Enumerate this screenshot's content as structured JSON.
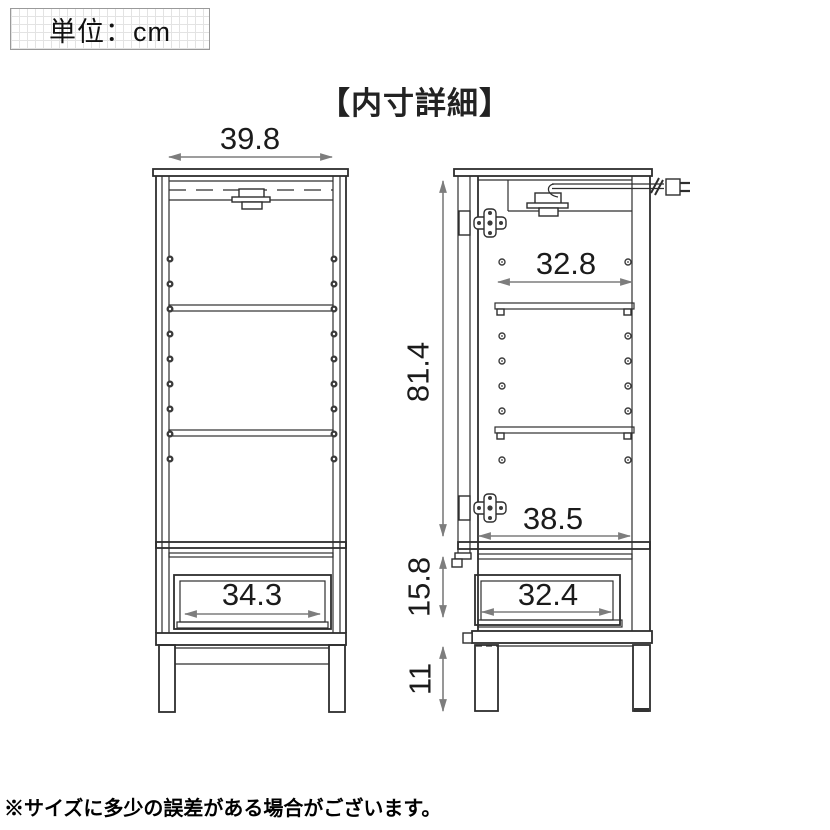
{
  "unit_box": {
    "label": "単位：cm"
  },
  "title": "【内寸詳細】",
  "note": "※サイズに多少の誤差がある場合がございます。",
  "colors": {
    "line": "#2e2e2e",
    "dimension_arrow": "#7d7d7d",
    "dimension_text": "#1b1b1b"
  },
  "diagram": {
    "unit": "cm",
    "left_view": {
      "dimensions": [
        {
          "name": "top-inner-width",
          "value": "39.8"
        },
        {
          "name": "drawer-inner-width",
          "value": "34.3"
        }
      ]
    },
    "right_view": {
      "dimensions": [
        {
          "name": "shelf-inner-width",
          "value": "32.8"
        },
        {
          "name": "upper-inner-height",
          "value": "81.4"
        },
        {
          "name": "bottom-inner-width",
          "value": "38.5"
        },
        {
          "name": "drawer-inner-height",
          "value": "15.8"
        },
        {
          "name": "drawer-inner-width",
          "value": "32.4"
        },
        {
          "name": "leg-height",
          "value": "11"
        }
      ]
    }
  }
}
